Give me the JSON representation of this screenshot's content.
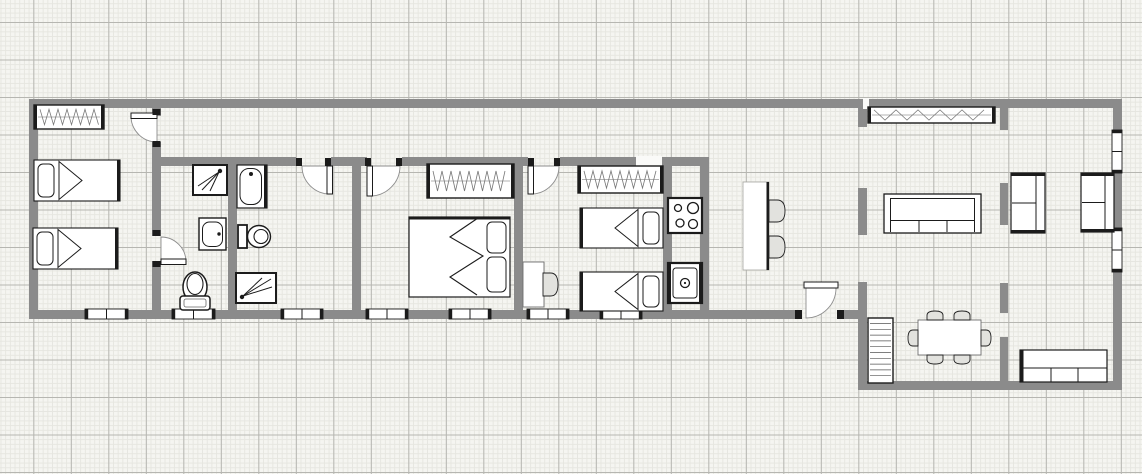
{
  "canvas": {
    "width": 1142,
    "height": 474
  },
  "palette": {
    "wall": "#8b8b8b",
    "line": "#1b1b1b",
    "soft": "#666666",
    "white": "#ffffff",
    "chair_fill": "#e2e2de",
    "gap_fill": "#fafaf8",
    "pattern": "#777777"
  },
  "walls": [
    [
      29,
      99,
      834,
      9
    ],
    [
      869,
      99,
      253,
      9
    ],
    [
      29,
      99,
      9,
      219
    ],
    [
      29,
      310,
      772,
      9
    ],
    [
      837,
      310,
      30,
      9
    ],
    [
      1113,
      99,
      9,
      291
    ],
    [
      862,
      381,
      260,
      9
    ],
    [
      152,
      108,
      9,
      8
    ],
    [
      152,
      142,
      9,
      94
    ],
    [
      152,
      261,
      9,
      57
    ],
    [
      228,
      157,
      9,
      161
    ],
    [
      352,
      157,
      9,
      161
    ],
    [
      514,
      157,
      9,
      161
    ],
    [
      663,
      157,
      9,
      161
    ],
    [
      700,
      157,
      9,
      161
    ],
    [
      152,
      157,
      144,
      9
    ],
    [
      331,
      157,
      36,
      9
    ],
    [
      402,
      157,
      126,
      9
    ],
    [
      560,
      157,
      76,
      9
    ],
    [
      662,
      157,
      47,
      9
    ],
    [
      858,
      99,
      9,
      28
    ],
    [
      858,
      188,
      9,
      47
    ],
    [
      858,
      282,
      9,
      108
    ],
    [
      1000,
      99,
      8,
      31
    ],
    [
      1000,
      183,
      8,
      42
    ],
    [
      1000,
      283,
      8,
      30
    ],
    [
      1000,
      337,
      8,
      45
    ]
  ],
  "wall_gaps": [
    [
      636,
      156,
      26,
      11
    ],
    [
      863,
      98,
      6,
      11
    ]
  ],
  "windows_h": [
    [
      85,
      309,
      43,
      10
    ],
    [
      172,
      309,
      43,
      10
    ],
    [
      281,
      309,
      42,
      10
    ],
    [
      366,
      309,
      42,
      10
    ],
    [
      449,
      309,
      42,
      10
    ],
    [
      527,
      309,
      42,
      10
    ],
    [
      600,
      309,
      42,
      10
    ]
  ],
  "windows_v": [
    [
      1112,
      130,
      10,
      43
    ],
    [
      1112,
      228,
      10,
      44
    ]
  ],
  "doors": [
    {
      "name": "bedroom1-door",
      "sector": "M157,116 L131,116 A26,26 0 0 0 157,142 Z",
      "leaf": [
        131,
        113,
        26,
        5.5
      ],
      "jambs": [
        [
          152.5,
          109,
          8,
          6
        ],
        [
          152.5,
          141,
          8,
          6
        ]
      ]
    },
    {
      "name": "ensuite-door",
      "sector": "M161,262 L186,262 A25,25 0 0 0 161,237 Z",
      "leaf": [
        161,
        259,
        25,
        5.5
      ],
      "jambs": [
        [
          152.5,
          230,
          8,
          6
        ],
        [
          152.5,
          261,
          8,
          6
        ]
      ]
    },
    {
      "name": "bathroom-door",
      "sector": "M330,166 L330,194 A28,28 0 0 1 302,166 Z",
      "leaf": [
        327,
        166,
        5.5,
        28
      ],
      "jambs": [
        [
          296,
          158,
          6,
          8
        ],
        [
          325,
          158,
          6,
          8
        ]
      ]
    },
    {
      "name": "bedroom2-door",
      "sector": "M370,166 L370,196 A30,30 0 0 0 400,166 Z",
      "leaf": [
        367,
        166,
        5.5,
        30
      ],
      "jambs": [
        [
          365,
          158,
          6,
          8
        ],
        [
          396,
          158,
          6,
          8
        ]
      ]
    },
    {
      "name": "bedroom3-door",
      "sector": "M531,166 L531,194 A28,28 0 0 0 559,166 Z",
      "leaf": [
        528,
        166,
        5.5,
        28
      ],
      "jambs": [
        [
          528,
          158,
          6,
          8
        ],
        [
          554,
          158,
          6,
          8
        ]
      ]
    },
    {
      "name": "rear-entry-door",
      "sector": "M806,288 L836,288 A30,30 0 0 1 806,318 Z",
      "leaf": [
        804,
        282,
        34,
        6
      ],
      "jambs": [
        [
          795,
          310,
          7,
          9
        ],
        [
          837,
          310,
          7,
          9
        ]
      ]
    }
  ],
  "furniture": [
    {
      "type": "wardrobe",
      "rect": [
        34,
        105,
        70,
        24
      ],
      "pattern": "dense"
    },
    {
      "type": "single-bed",
      "rect": [
        34,
        160,
        86,
        41
      ],
      "pillow": "w"
    },
    {
      "type": "single-bed",
      "rect": [
        33,
        228,
        85,
        41
      ],
      "pillow": "w"
    },
    {
      "type": "shower",
      "rect": [
        193,
        165,
        34,
        30
      ],
      "head": "tr"
    },
    {
      "type": "bathroom-sink",
      "rect": [
        199,
        218,
        27,
        32
      ]
    },
    {
      "type": "toilet-front",
      "rect": [
        180,
        272,
        30,
        38
      ]
    },
    {
      "type": "bathtub",
      "rect": [
        237,
        165,
        30,
        43
      ]
    },
    {
      "type": "toilet-side",
      "rect": [
        238,
        224,
        32,
        24
      ]
    },
    {
      "type": "shower",
      "rect": [
        236,
        273,
        40,
        30
      ],
      "head": "bl"
    },
    {
      "type": "wardrobe",
      "rect": [
        427,
        164,
        87,
        34
      ],
      "pattern": "dense"
    },
    {
      "type": "double-bed",
      "rect": [
        409,
        217,
        101,
        80
      ]
    },
    {
      "type": "wardrobe",
      "rect": [
        578,
        166,
        85,
        27
      ],
      "pattern": "dense"
    },
    {
      "type": "desk",
      "rect": [
        523,
        262,
        21,
        45
      ]
    },
    {
      "type": "chair",
      "rect": [
        543,
        273,
        15,
        23
      ],
      "dir": "right"
    },
    {
      "type": "single-bed",
      "rect": [
        580,
        208,
        83,
        40
      ],
      "pillow": "e"
    },
    {
      "type": "single-bed",
      "rect": [
        580,
        272,
        83,
        39
      ],
      "pillow": "e"
    },
    {
      "type": "stove",
      "rect": [
        668,
        198,
        34,
        35
      ]
    },
    {
      "type": "kitchen-sink",
      "rect": [
        668,
        263,
        34,
        40
      ]
    },
    {
      "type": "bar-counter",
      "rect": [
        743,
        182,
        26,
        88
      ]
    },
    {
      "type": "chair",
      "rect": [
        769,
        200,
        16,
        22
      ],
      "dir": "right"
    },
    {
      "type": "chair",
      "rect": [
        769,
        236,
        16,
        22
      ],
      "dir": "right"
    },
    {
      "type": "wardrobe",
      "rect": [
        868,
        107,
        127,
        16
      ],
      "pattern": "sparse"
    },
    {
      "type": "sofa",
      "rect": [
        884,
        194,
        97,
        39
      ]
    },
    {
      "type": "loveseat",
      "rect": [
        1011,
        173,
        34,
        60
      ]
    },
    {
      "type": "loveseat",
      "rect": [
        1081,
        173,
        33,
        59
      ]
    },
    {
      "type": "bookshelf",
      "rect": [
        868,
        318,
        25,
        65
      ]
    },
    {
      "type": "dining-table",
      "rect": [
        918,
        320,
        63,
        35
      ]
    },
    {
      "type": "chair",
      "rect": [
        927,
        311,
        16,
        9
      ],
      "dir": "up"
    },
    {
      "type": "chair",
      "rect": [
        954,
        311,
        16,
        9
      ],
      "dir": "up"
    },
    {
      "type": "chair",
      "rect": [
        927,
        355,
        16,
        9
      ],
      "dir": "down"
    },
    {
      "type": "chair",
      "rect": [
        954,
        355,
        16,
        9
      ],
      "dir": "down"
    },
    {
      "type": "chair",
      "rect": [
        908,
        330,
        10,
        16
      ],
      "dir": "left"
    },
    {
      "type": "chair",
      "rect": [
        981,
        330,
        10,
        16
      ],
      "dir": "right"
    },
    {
      "type": "sideboard",
      "rect": [
        1020,
        350,
        87,
        32
      ]
    }
  ]
}
